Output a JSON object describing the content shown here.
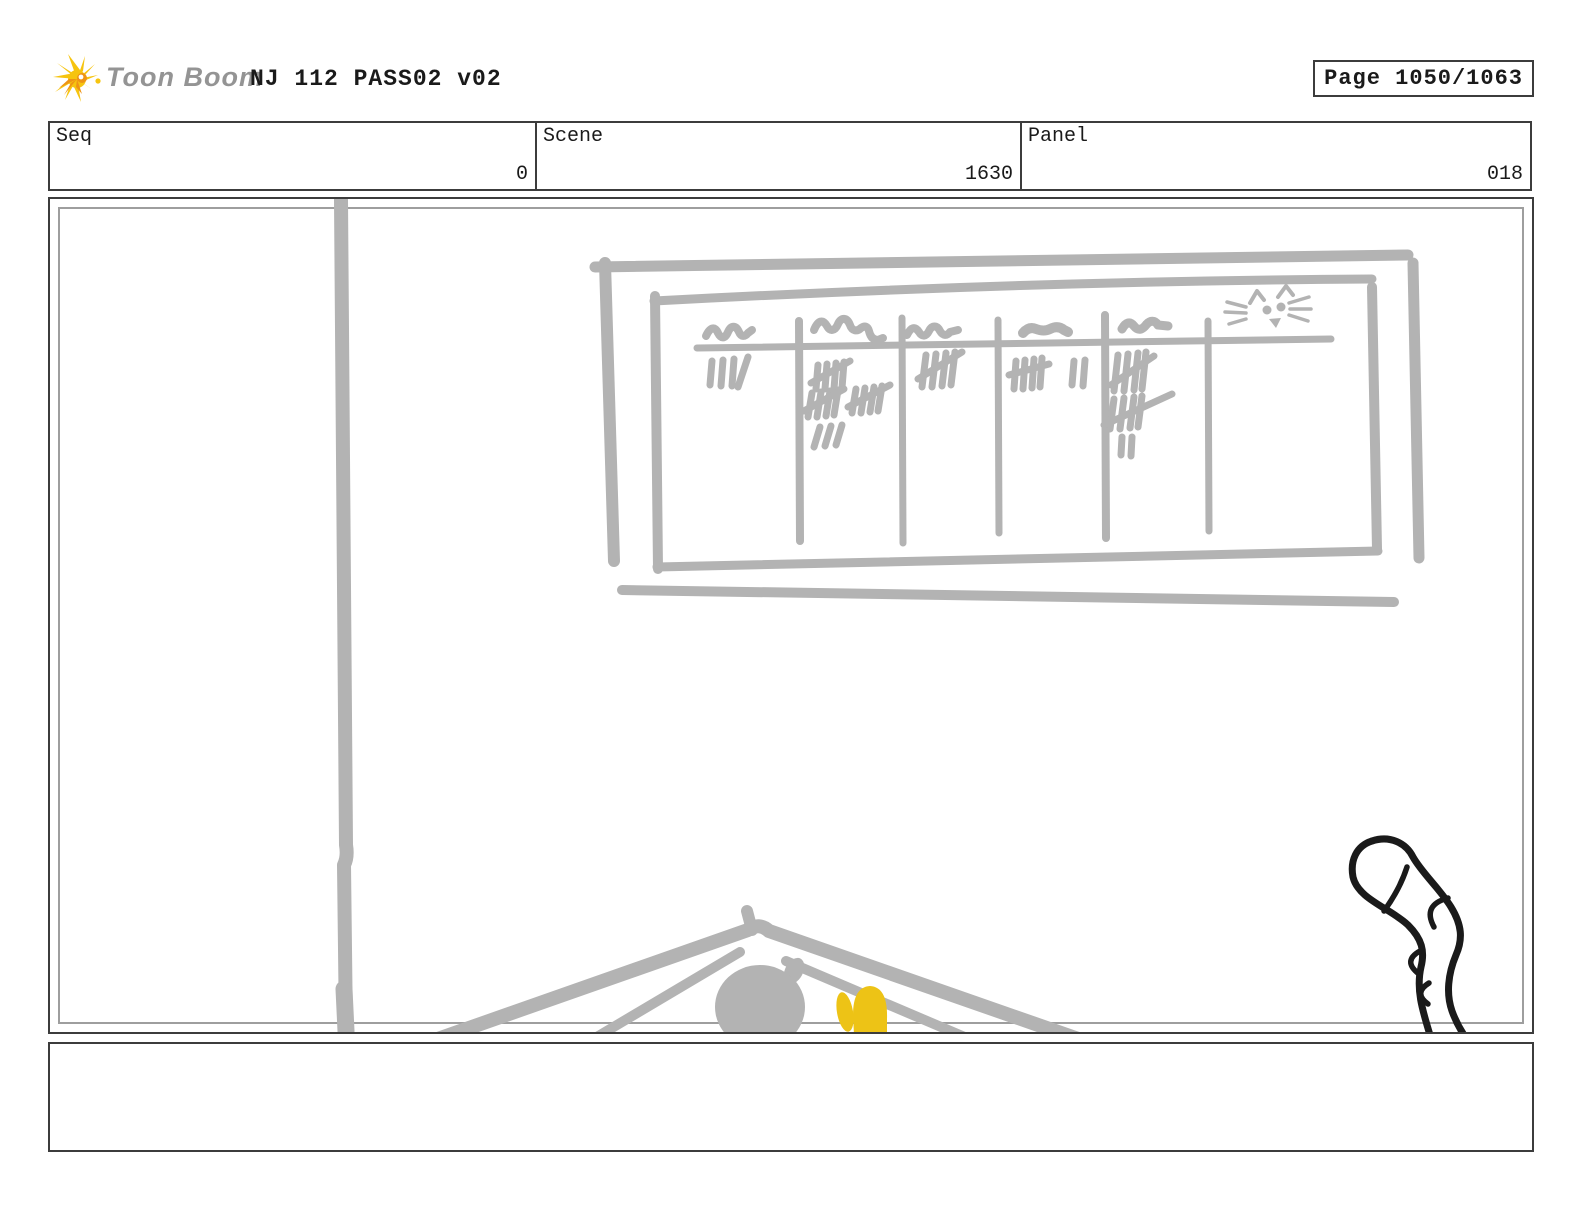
{
  "page": {
    "logo_text": "Toon Boom",
    "title": "NJ 112 PASS02 v02",
    "page_label": "Page 1050/1063"
  },
  "fields": {
    "seq": {
      "label": "Seq",
      "value": "0"
    },
    "scene": {
      "label": "Scene",
      "value": "1630"
    },
    "panel": {
      "label": "Panel",
      "value": "018"
    }
  },
  "storyboard_panel": {
    "sketch_elements": [
      "pole",
      "whiteboard-scoreboard",
      "tally-marks",
      "cat-face-doodle",
      "rooftop",
      "character-head",
      "yellow-mitten",
      "cat-tail"
    ],
    "whiteboard_tally_counts": [
      4,
      18,
      5,
      7,
      12
    ],
    "colors": {
      "sketch_gray": "#b3b3b3",
      "accent_yellow": "#edc316",
      "ink_black": "#1a1a1a",
      "logo_yellow": "#f6c40f",
      "logo_orange": "#ee9414",
      "border_dark": "#3c3c3c",
      "border_inner_gray": "#9e9e9e"
    }
  },
  "caption": {
    "text": ""
  }
}
